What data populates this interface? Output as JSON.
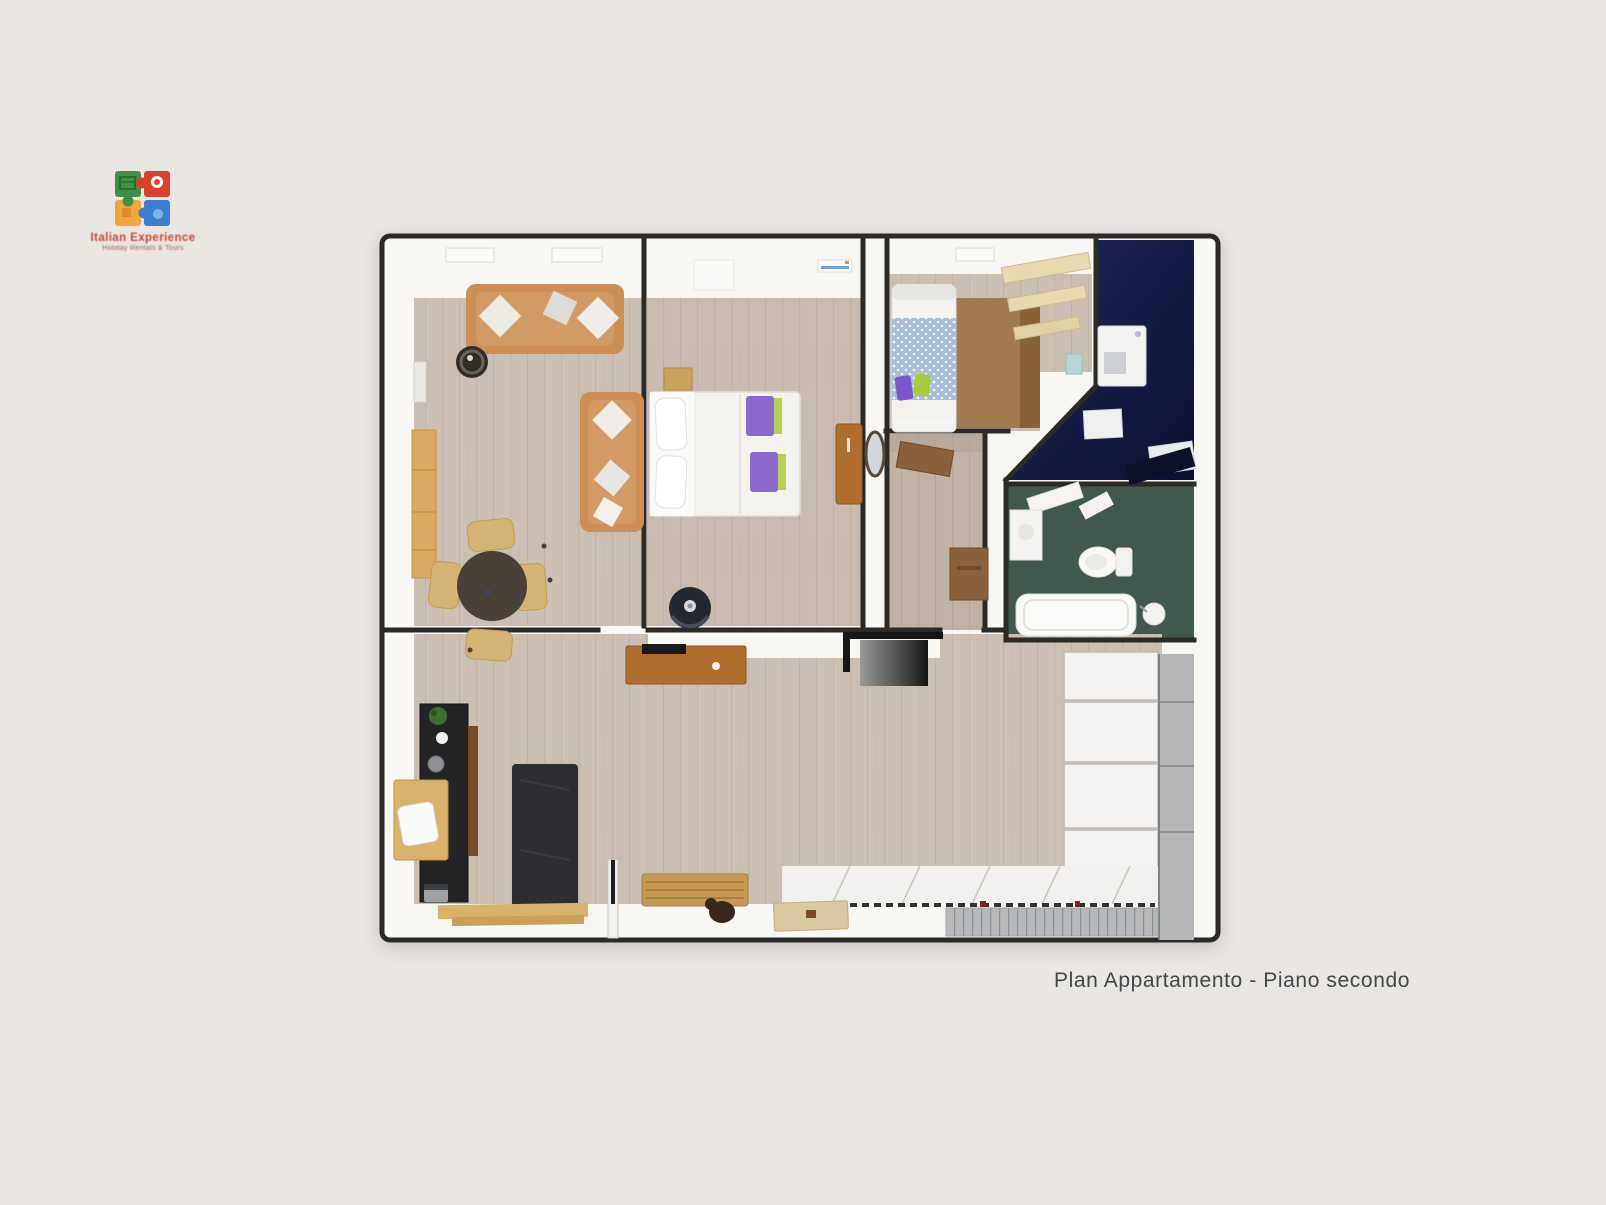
{
  "page": {
    "background_color": "#e9e6e1"
  },
  "logo": {
    "brand": "Italian Experience",
    "tagline": "Holiday Rentals & Tours",
    "puzzle_colors": {
      "top_left_green": "#3f9044",
      "top_right_red": "#d84330",
      "bottom_left_yellow": "#f1a73b",
      "bottom_right_blue": "#3e7ed2"
    },
    "brand_text_color": "#c8473a"
  },
  "caption": {
    "text": "Plan Appartamento - Piano secondo",
    "color": "#42474b"
  },
  "floor_plan_colors": {
    "wall_outline": "#2b2a27",
    "wall_fill": "#f8f7f4",
    "wood_floor": "#cbbfb3",
    "wood_floor_dark": "#c0b2a5",
    "study_navy": "#171f4e",
    "bathroom_green": "#41584e",
    "sofa_tan": "#ce8f57",
    "furniture_brown": "#b06e2e",
    "accent_purple": "#8a68cc",
    "accent_lime": "#b0cb48",
    "bed_blue": "#a9bed9",
    "closet_white": "#f3f2f0",
    "panel_gray": "#b4b6b7",
    "kitchen_black": "#242427",
    "dining_table_dark": "#4a4138",
    "chair_tan": "#d4b375"
  }
}
